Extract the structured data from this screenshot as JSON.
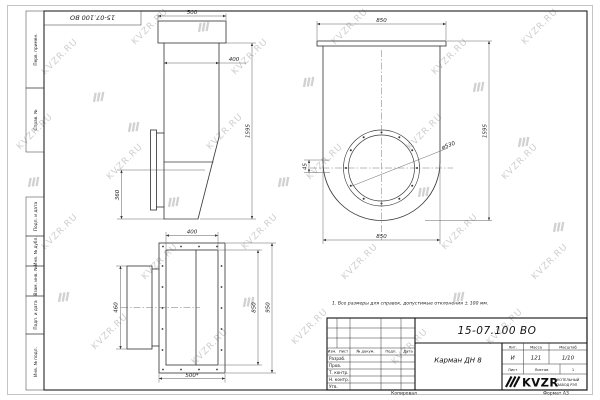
{
  "watermark": {
    "text": "KVZR.RU"
  },
  "stamp": {
    "doc_number": "15-07.100 ВО"
  },
  "margin_labels": [
    "Перв. примен.",
    "Справ. №",
    "Подп. и дата",
    "Инв. № дубл.",
    "Взам. инв. №",
    "Подп. и дата",
    "Инв. № подл."
  ],
  "note": "1. Все размеры для справок, допустимые отклонения ± 100 мм.",
  "views": {
    "side": {
      "flange_width": "500",
      "body_width": "400",
      "height": "1595",
      "lower_height": "360"
    },
    "front": {
      "top_width": "850",
      "height": "1595",
      "bottom_width": "850",
      "circle_diameter": "ø530",
      "offset": "45"
    },
    "plan": {
      "top_width": "400",
      "bottom_width": "500*",
      "inner_height": "850",
      "outer_height": "950",
      "flange_height": "460"
    }
  },
  "title_block": {
    "doc_number": "15-07.100 ВО",
    "part_name": "Карман ДН 8",
    "columns": {
      "izm": "Изм.",
      "list": "Лист",
      "doc": "№ докум.",
      "podp": "Подп.",
      "date": "Дата"
    },
    "rows": [
      "Разраб.",
      "Пров.",
      "Т. контр.",
      "Н. контр.",
      "Утв."
    ],
    "lit_label": "Лит.",
    "lit_value": "И",
    "mass_label": "Масса",
    "mass_value": "121",
    "scale_label": "Масштаб",
    "scale_value": "1/10",
    "sheet_label": "Лист",
    "sheets_label": "Листов",
    "sheets_value": "1",
    "company_logo": "KVZR",
    "company_line1": "КОТЕЛЬНЫЙ",
    "company_line2": "ЗАВОД РЭП"
  },
  "footer": {
    "copied": "Копировал",
    "format": "Формат А3"
  }
}
